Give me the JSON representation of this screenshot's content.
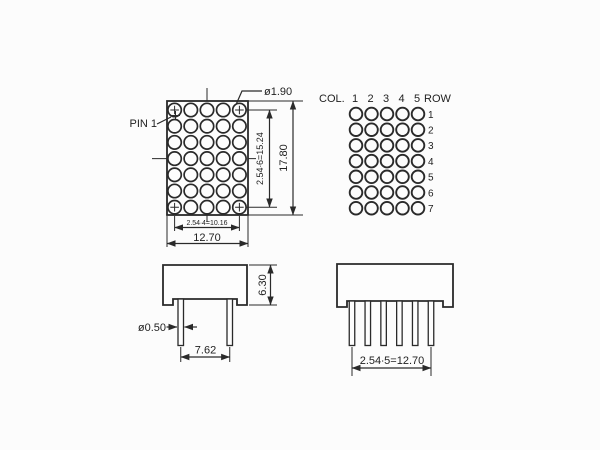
{
  "colors": {
    "line": "#2a2a2a",
    "background": "#fcfcfc"
  },
  "front_view": {
    "pin1_label": "PIN 1",
    "dot_diameter_label": "ø1.90",
    "width_inner_dim": "2.54∙4=10.16",
    "width_outer_dim": "12.70",
    "height_inner_dim": "2.54∙6=15.24",
    "height_outer_dim": "17.80",
    "grid": {
      "cols": 5,
      "rows": 7
    }
  },
  "pin_map": {
    "col_label": "COL.",
    "row_label": "ROW",
    "col_numbers": [
      "1",
      "2",
      "3",
      "4",
      "5"
    ],
    "row_numbers": [
      "1",
      "2",
      "3",
      "4",
      "5",
      "6",
      "7"
    ],
    "grid": {
      "cols": 5,
      "rows": 7
    }
  },
  "side_view": {
    "height_dim": "6.30",
    "pin_diameter_label": "ø0.50",
    "pin_pitch_dim": "7.62"
  },
  "bottom_view": {
    "pin_row_dim": "2.54∙5=12.70"
  }
}
